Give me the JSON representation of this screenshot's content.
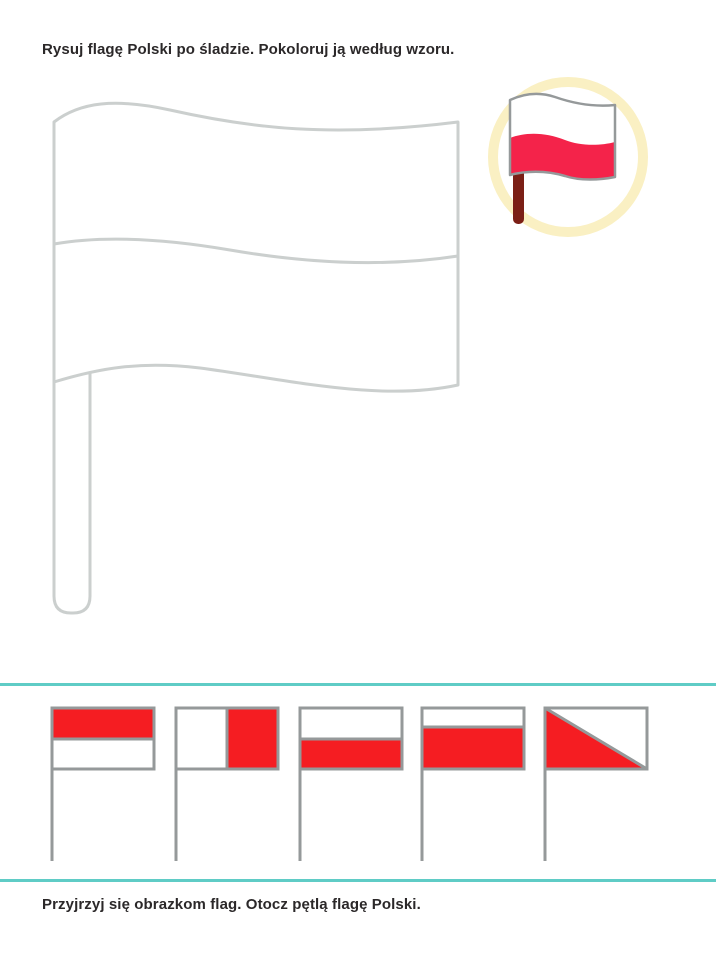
{
  "instructions": {
    "top": "Rysuj flagę Polski po śladzie. Pokoloruj ją według wzoru.",
    "bottom": "Przyjrzyj się obrazkom flag. Otocz pętlą flagę Polski."
  },
  "colors": {
    "text": "#2b2829",
    "trace_outline": "#cbcfce",
    "flag_border_gray": "#95999a",
    "flag_red": "#f51d22",
    "example_red": "#f4234a",
    "example_pole_maroon": "#7b1f16",
    "ring_yellow": "#faf0c3",
    "divider_cyan": "#5fccc6",
    "paper_white": "#ffffff"
  },
  "trace_flag": {
    "description": "large traceable outline of a wavy two-stripe flag on a pole, uncolored",
    "stripes": 2
  },
  "example_badge": {
    "icon": "poland-flag-icon",
    "description": "colored sample: Polish flag, white top stripe, red bottom stripe, dark red pole, inside pale yellow ring"
  },
  "flag_options": [
    {
      "id": 1,
      "pattern": "horizontal halves",
      "top": "red",
      "bottom": "white",
      "is_poland": false
    },
    {
      "id": 2,
      "pattern": "vertical halves",
      "left": "white",
      "right": "red",
      "is_poland": false
    },
    {
      "id": 3,
      "pattern": "horizontal halves",
      "top": "white",
      "bottom": "red",
      "is_poland": true
    },
    {
      "id": 4,
      "pattern": "thin white top stripe",
      "top": "white",
      "bottom": "red",
      "is_poland": false
    },
    {
      "id": 5,
      "pattern": "diagonal split, red lower-left triangle",
      "upper": "white",
      "lower": "red",
      "is_poland": false
    }
  ]
}
